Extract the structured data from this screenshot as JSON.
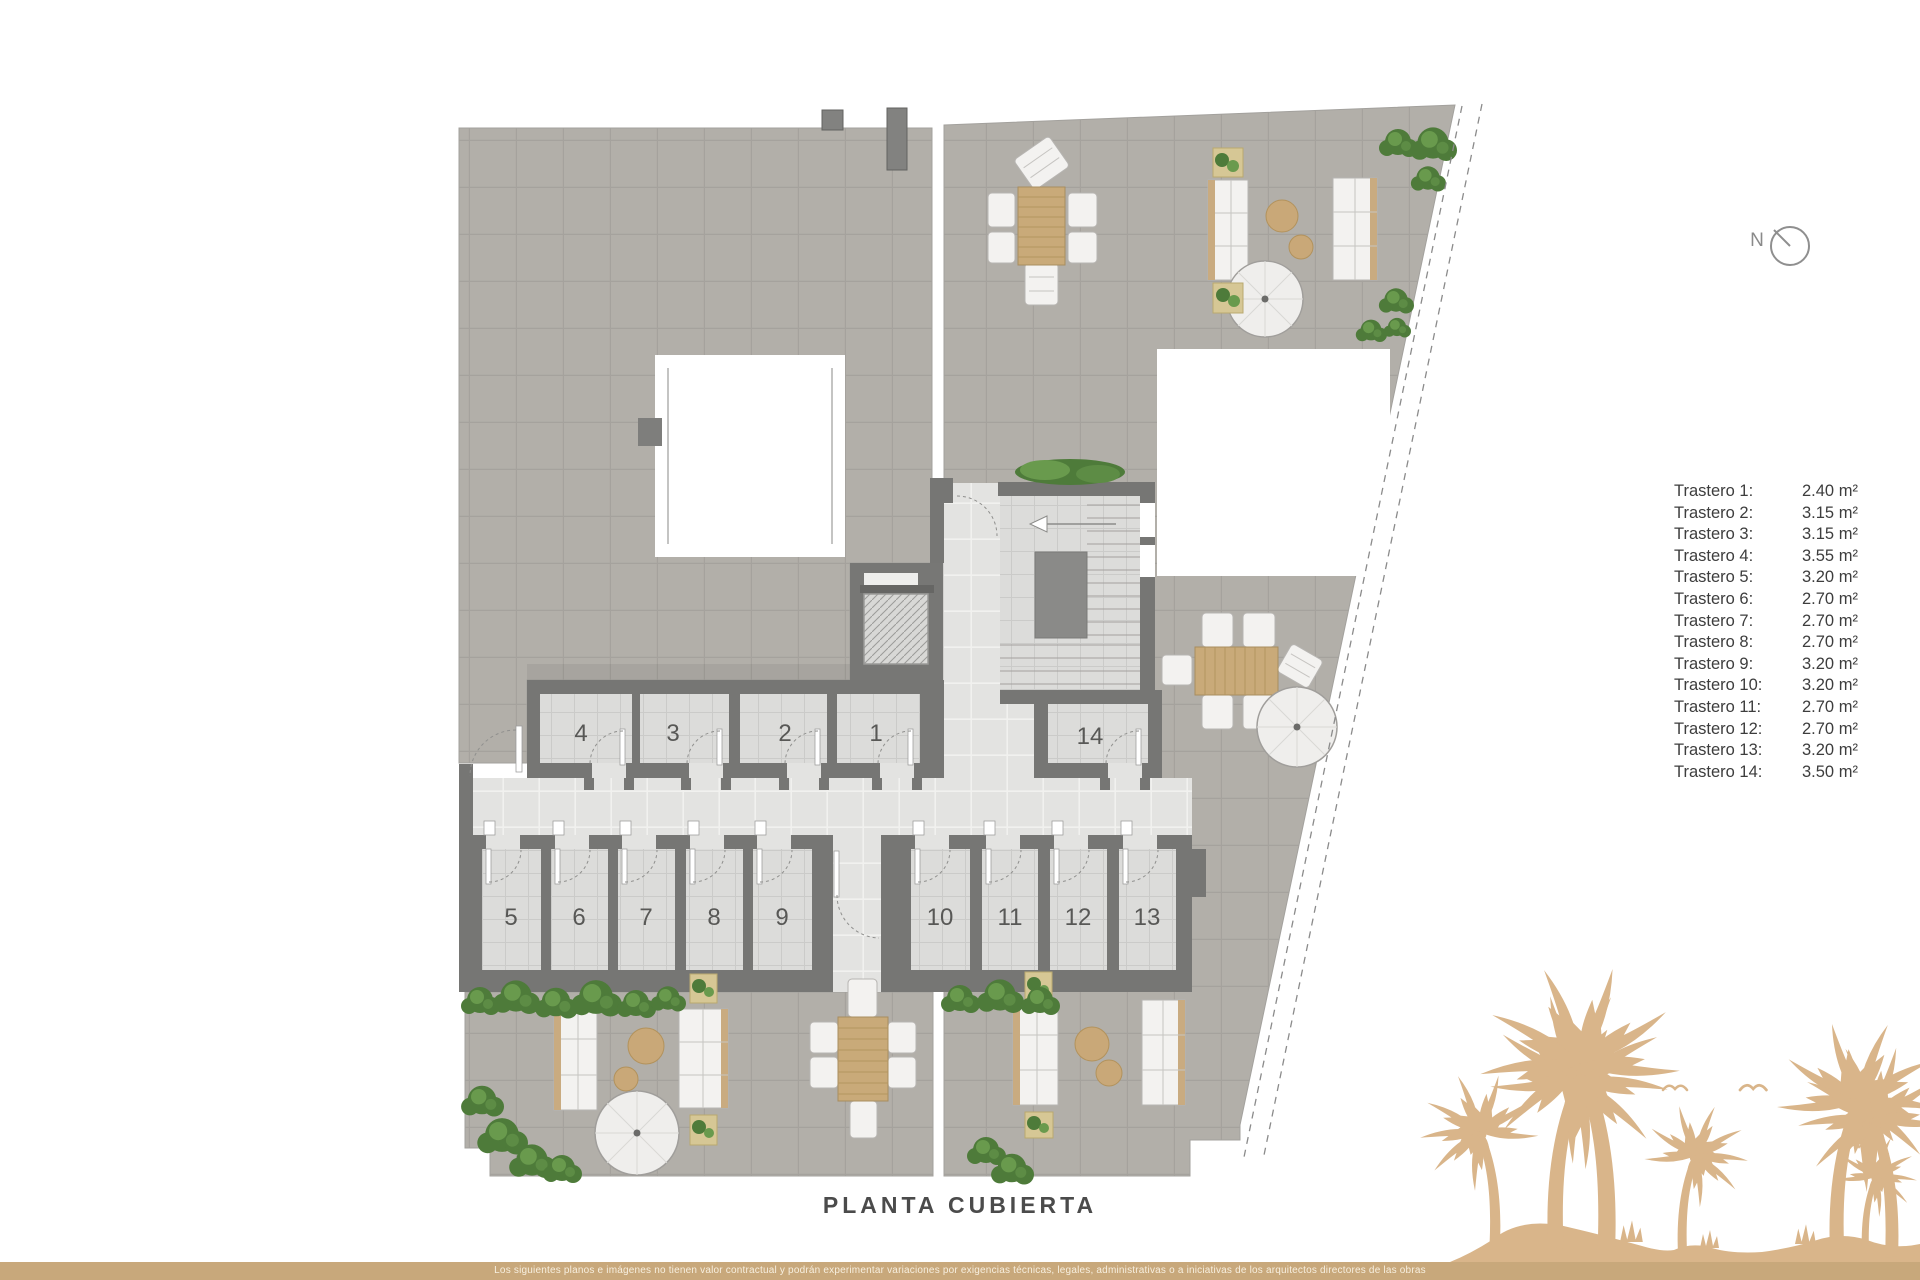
{
  "plan": {
    "title": "PLANTA CUBIERTA",
    "compass_label": "N",
    "room_numbers": [
      "1",
      "2",
      "3",
      "4",
      "5",
      "6",
      "7",
      "8",
      "9",
      "10",
      "11",
      "12",
      "13",
      "14"
    ]
  },
  "legend": {
    "rows": [
      {
        "label": "Trastero 1:",
        "value": "2.40 m²"
      },
      {
        "label": "Trastero 2:",
        "value": "3.15 m²"
      },
      {
        "label": "Trastero 3:",
        "value": "3.15 m²"
      },
      {
        "label": "Trastero 4:",
        "value": "3.55 m²"
      },
      {
        "label": "Trastero 5:",
        "value": "3.20 m²"
      },
      {
        "label": "Trastero 6:",
        "value": "2.70 m²"
      },
      {
        "label": "Trastero 7:",
        "value": "2.70 m²"
      },
      {
        "label": "Trastero 8:",
        "value": "2.70 m²"
      },
      {
        "label": "Trastero 9:",
        "value": "3.20 m²"
      },
      {
        "label": "Trastero 10:",
        "value": "3.20 m²"
      },
      {
        "label": "Trastero 11:",
        "value": "2.70 m²"
      },
      {
        "label": "Trastero 12:",
        "value": "2.70 m²"
      },
      {
        "label": "Trastero 13:",
        "value": "3.20 m²"
      },
      {
        "label": "Trastero 14:",
        "value": "3.50 m²"
      }
    ]
  },
  "footer": {
    "disclaimer": "Los siguientes planos e imágenes no tienen valor contractual y podrán experimentar variaciones por exigencias técnicas, legales, administrativas o a iniciativas de los arquitectos directores de las obras"
  },
  "colors": {
    "accent_gold": "#c8a87b",
    "palm_tan": "#d9b58a",
    "wall_gray": "#767674",
    "plant_green": "#4e7b3a"
  }
}
